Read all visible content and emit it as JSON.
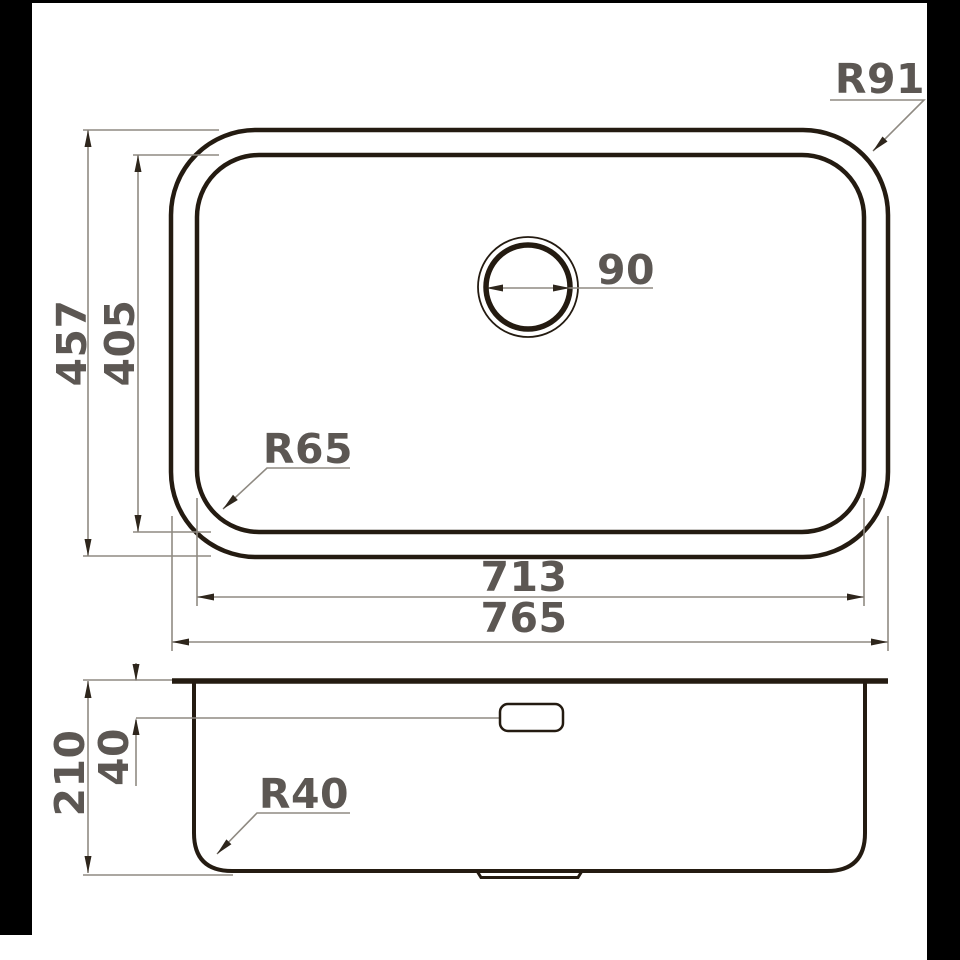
{
  "diagram": {
    "type": "technical-dimension-drawing",
    "views": {
      "top_view": {
        "height_outer": "457",
        "height_inner": "405",
        "width_inner": "713",
        "width_outer": "765",
        "corner_radius_outer": "R91",
        "corner_radius_inner": "R65",
        "drain_diameter": "90"
      },
      "side_view": {
        "total_depth": "210",
        "overflow_offset": "40",
        "bottom_corner_radius": "R40"
      }
    },
    "colors": {
      "object_line": "#241b11",
      "dimension_line": "#8f8a82",
      "arrowhead": "#2e261c",
      "label_text": "#5c5753",
      "background": "#ffffff",
      "frame_bar": "#000000"
    }
  }
}
